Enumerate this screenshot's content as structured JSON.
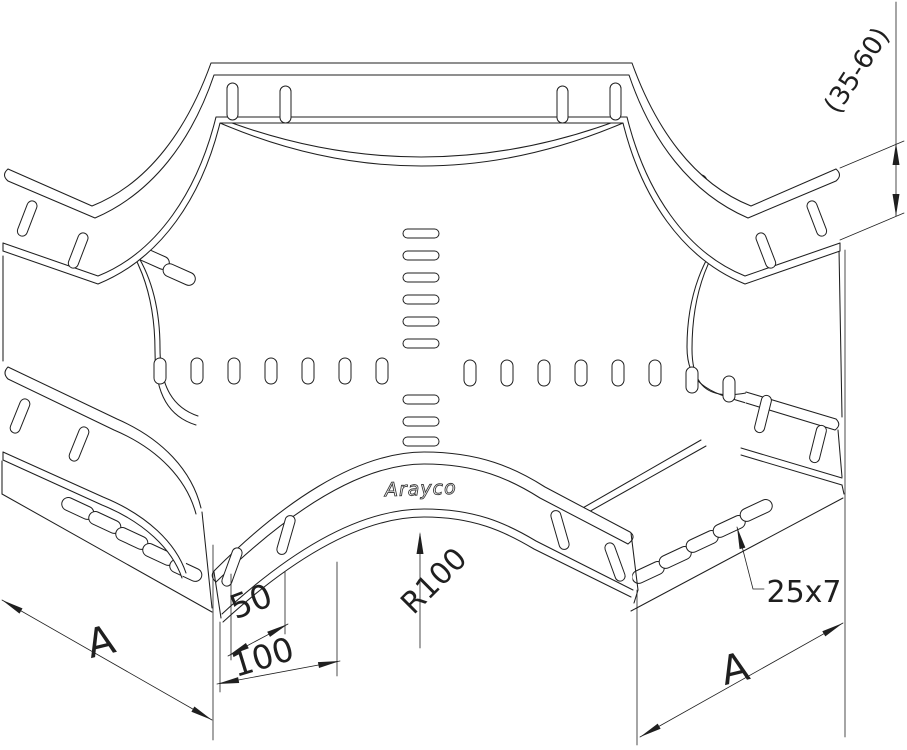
{
  "page": {
    "background": "#ffffff",
    "line_color": "#1f1f1f"
  },
  "drawing": {
    "subject": "cable-tray-4way-cross-fitting-isometric",
    "logo_text": "Arayco",
    "labels": {
      "height_range": "(35-60)",
      "slot_size": "25x7",
      "radius": "R100",
      "pitch_small": "50",
      "pitch_large": "100",
      "width_left": "A",
      "width_right": "A"
    }
  }
}
